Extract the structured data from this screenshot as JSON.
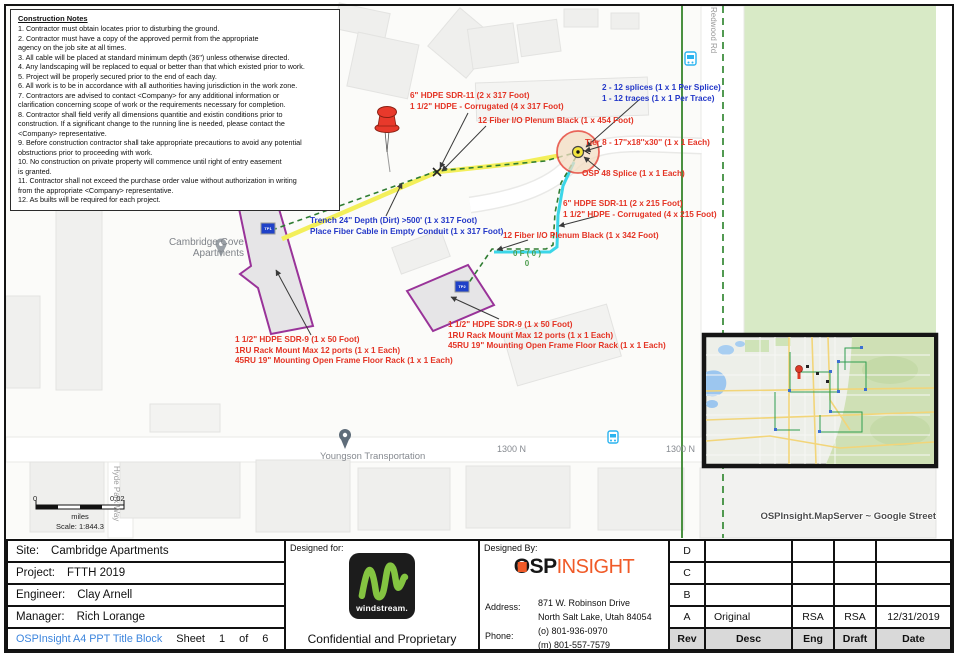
{
  "notes": {
    "title": "Construction Notes",
    "body": "1. Contractor must obtain locates prior to disturbing the ground.\n2. Contractor must have a copy of the approved permit from the  appropriate\nagency on the job site at all times.\n3. All cable will be placed at standard minimum depth (36\") unless otherwise  directed.\n4. Any landscaping will be replaced to equal or better than that which existed prior to work.\n5. Project will be properly secured prior to the end of each day.\n6. All work is to be in accordance with all authorities having jurisdiction in the work zone.\n7. Contractors are advised to contact <Company> for any additional information or\nclarification concerning scope of work or the requirements necessary for completion.\n8. Contractor shall field verify all dimensions quantitie and existin conditions prior to\nconstruction.  If a significant change to the running line is needed, please contact the\n<Company> representative.\n9. Before construction contractor shall take appropriate precautions to avoid any potential\nobstructions prior to proceeding with work.\n10. No construction on private property will commence until right of entry easement\nis granted.\n11. Contractor shall not exceed the purchase order value without authorization in writing\nfrom the appropriate <Company> representative.\n12. As builts will be required for each project."
  },
  "map": {
    "annotations": {
      "conduit_317": "6\" HDPE SDR-11 (2 x 317 Foot)\n1 1/2\" HDPE - Corrugated (4 x 317 Foot)",
      "fiber_454": "12 Fiber I/O Plenum Black (1 x 454 Foot)",
      "splices": "2 - 12 splices (1 x 1 Per Splice)\n1 - 12 traces (1 x 1 Per Trace)",
      "vault": "Tier 8 - 17''x18''x30'' (1 x 1 Each)",
      "osp_splice": "OSP 48 Splice (1 x 1 Each)",
      "conduit_215": "6\" HDPE SDR-11 (2 x 215 Foot)\n1 1/2\" HDPE - Corrugated (4 x 215 Foot)",
      "fiber_342": "12 Fiber I/O Plenum Black (1 x 342 Foot)",
      "trench": "Trench 24'' Depth  (Dirt)   >500' (1 x 317 Foot)\nPlace Fiber Cable in Empty Conduit (1 x 317 Foot)",
      "fiber_count": "0 F ( 0 )\n0",
      "rack_left": "1 1/2\" HDPE SDR-9 (1 x 50 Foot)\n1RU Rack Mount Max 12 ports (1 x 1 Each)\n45RU 19\" Mounting Open Frame Floor Rack (1 x 1 Each)",
      "rack_right": "1 1/2\" HDPE SDR-9 (1 x 50 Foot)\n1RU Rack Mount Max 12 ports (1 x 1 Each)\n45RU 19\" Mounting Open Frame Floor Rack (1 x 1 Each)"
    },
    "labels": {
      "apartments": "Cambridge Cove\nApartments",
      "youngson": "Youngson Transportation",
      "road_1300n_a": "1300 N",
      "road_1300n_b": "1300 N",
      "hyde_park_way": "Hyde Park Way",
      "redwood_rd": "Redwood Rd"
    },
    "tp1": "TP1",
    "tp2": "TP2",
    "scalebar": {
      "zero": "0",
      "max": "0.02",
      "unit": "miles",
      "ratio": "Scale: 1:844.3"
    },
    "attribution": "OSPInsight.MapServer ~ Google Street"
  },
  "titleblock": {
    "site_label": "Site:",
    "site": "Cambridge Apartments",
    "project_label": "Project:",
    "project": "FTTH 2019",
    "engineer_label": "Engineer:",
    "engineer": "Clay Arnell",
    "manager_label": "Manager:",
    "manager": "Rich Lorange",
    "doc_name": "OSPInsight A4 PPT Title Block",
    "sheet_label": "Sheet",
    "sheet_number": "1",
    "of_label": "of",
    "sheets_total": "6",
    "designed_for_label": "Designed for:",
    "windstream_wordmark": "windstream.",
    "confidential": "Confidential and Proprietary",
    "designed_by_label": "Designed By:",
    "logo_osp": "OSP",
    "logo_insight": "INSIGHT",
    "address_label": "Address:",
    "address_line1": "871 W. Robinson Drive",
    "address_line2": "North Salt Lake, Utah  84054",
    "phone_label": "Phone:",
    "phone_office": "(o) 801-936-0970",
    "phone_mobile": "(m) 801-557-7579",
    "rev_table": {
      "headers": [
        "Rev",
        "Desc",
        "Eng",
        "Draft",
        "Date"
      ],
      "rows": [
        {
          "rev": "D",
          "desc": "",
          "eng": "",
          "draft": "",
          "date": ""
        },
        {
          "rev": "C",
          "desc": "",
          "eng": "",
          "draft": "",
          "date": ""
        },
        {
          "rev": "B",
          "desc": "",
          "eng": "",
          "draft": "",
          "date": ""
        },
        {
          "rev": "A",
          "desc": "Original",
          "eng": "RSA",
          "draft": "RSA",
          "date": "12/31/2019"
        }
      ]
    }
  },
  "colors": {
    "annotation_red": "#e43425",
    "annotation_blue": "#2438c8",
    "trench_yellow": "#f3ef5a",
    "fiber_green": "#2f7d32",
    "drop_cyan": "#3bd6e8",
    "building_purple": "#993399",
    "park_green": "#d8eac6",
    "windstream_green": "#84c441",
    "osp_orange": "#f05a28",
    "titleblock_link_blue": "#3c85dd"
  }
}
